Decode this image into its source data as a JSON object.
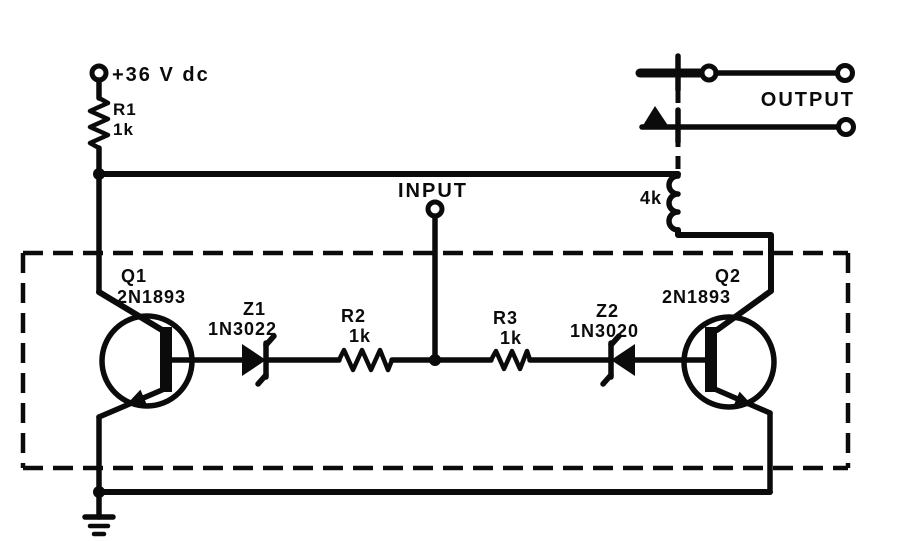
{
  "diagram": {
    "colors": {
      "ink": "#0b0b0b",
      "background": "#ffffff"
    },
    "supply": {
      "label": "+36 V dc"
    },
    "input": {
      "label": "INPUT"
    },
    "output": {
      "label": "OUTPUT"
    },
    "relay_coil": {
      "value": "4k"
    },
    "r1": {
      "name": "R1",
      "value": "1k"
    },
    "r2": {
      "name": "R2",
      "value": "1k"
    },
    "r3": {
      "name": "R3",
      "value": "1k"
    },
    "q1": {
      "name": "Q1",
      "part": "2N1893"
    },
    "q2": {
      "name": "Q2",
      "part": "2N1893"
    },
    "z1": {
      "name": "Z1",
      "part": "1N3022"
    },
    "z2": {
      "name": "Z2",
      "part": "1N3020"
    }
  }
}
